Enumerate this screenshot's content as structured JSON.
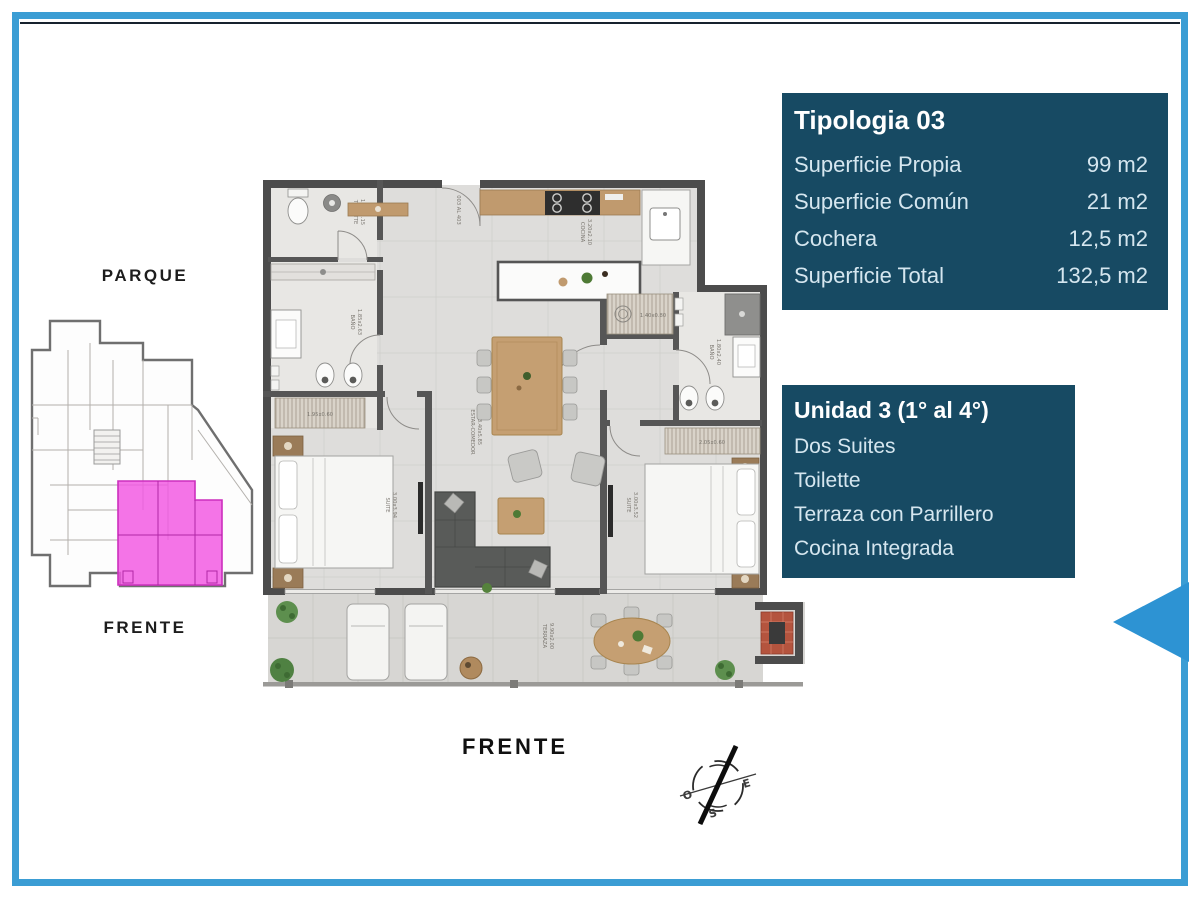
{
  "colors": {
    "frame": "#3b9dd4",
    "navy_line": "#16222e",
    "card_bg": "#174a63",
    "card_text": "#d5e6ef",
    "card_title": "#ffffff",
    "highlight_unit": "#f156e2",
    "arrow": "#2d93d3"
  },
  "key_plan": {
    "top_label": "PARQUE",
    "bottom_label": "FRENTE"
  },
  "floor_plan": {
    "front_label": "FRENTE",
    "entrance": "003 AL 403",
    "rooms": {
      "toilette": {
        "name": "TOILETTE",
        "dims": "1.05x1.15"
      },
      "bano1": {
        "name": "BAÑO",
        "dims": "1.85x2.63"
      },
      "cocina": {
        "name": "COCINA",
        "dims": "3.20x2.10"
      },
      "estar": {
        "name": "ESTAR-COMEDOR",
        "dims": "3.40x5.85"
      },
      "suite1": {
        "name": "SUITE",
        "dims": "3.00x3.94"
      },
      "suite2": {
        "name": "SUITE",
        "dims": "3.00x3.52"
      },
      "bano2": {
        "name": "BAÑO",
        "dims": "1.80x2.40"
      },
      "terraza": {
        "name": "TERRAZA",
        "dims": "9.90x2.00"
      }
    },
    "closets": {
      "c1": "1.95x0.60",
      "c2": "2.05x0.60",
      "c3": "1.40x0.80"
    }
  },
  "compass": {
    "o": "O",
    "e": "E",
    "s": "S"
  },
  "tipologia_card": {
    "title": "Tipologia 03",
    "rows": [
      {
        "label": "Superficie Propia",
        "value": "99 m2"
      },
      {
        "label": "Superficie Común",
        "value": "21 m2"
      },
      {
        "label": "Cochera",
        "value": "12,5 m2"
      },
      {
        "label": "Superficie Total",
        "value": "132,5 m2"
      }
    ]
  },
  "unidad_card": {
    "title": "Unidad 3 (1° al 4°)",
    "features": [
      "Dos Suites",
      "Toilette",
      "Terraza con Parrillero",
      "Cocina Integrada"
    ]
  }
}
